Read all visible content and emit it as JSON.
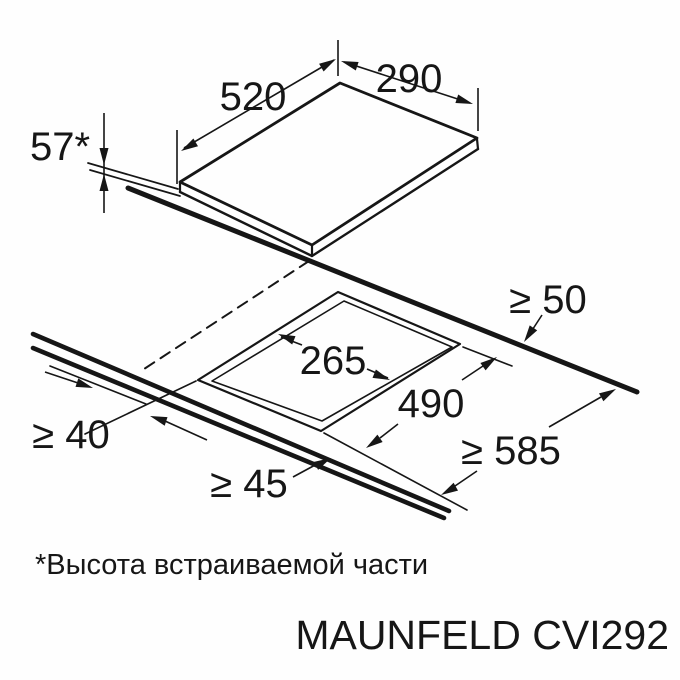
{
  "diagram": {
    "type": "appliance-installation-drawing",
    "product_model": "MAUNFELD CVI292",
    "footnote_text": "*Высота встраиваемой части",
    "appliance_mm": {
      "width": "520",
      "depth": "290",
      "built_in_height": "57*"
    },
    "cutout_mm": {
      "length": "490",
      "depth": "265"
    },
    "clearances_mm": {
      "rear_min": "≥ 50",
      "side_min": "≥ 40",
      "front_min": "≥ 45",
      "worktop_depth_min": "≥ 585"
    }
  },
  "labels": {
    "width": "520",
    "depth": "290",
    "height": "57*",
    "cutout_depth": "265",
    "cutout_width": "490",
    "clearance_rear": "≥ 50",
    "clearance_side": "≥ 40",
    "clearance_front": "≥ 45",
    "worktop_depth": "≥ 585",
    "footnote": "*Высота встраиваемой части",
    "brand_model": "MAUNFELD CVI292"
  }
}
